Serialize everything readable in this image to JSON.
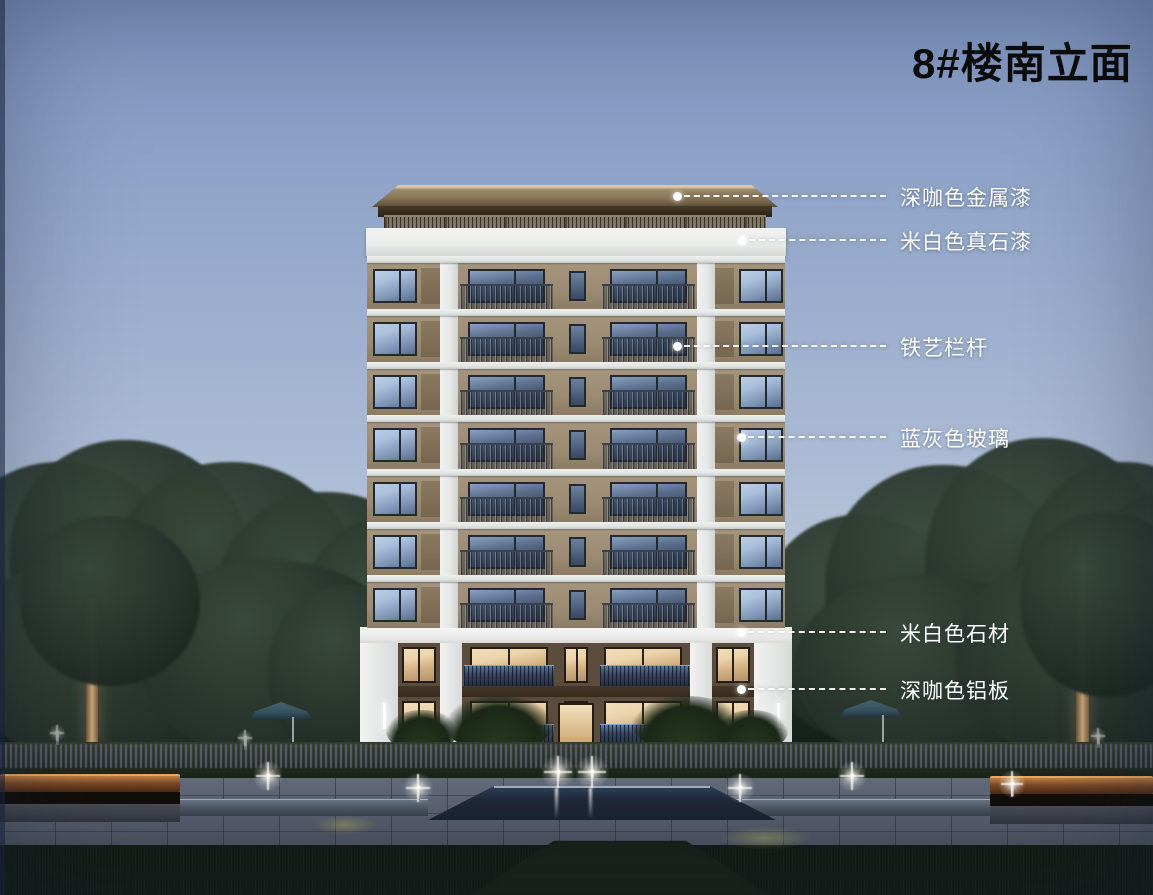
{
  "title": "8#楼南立面",
  "building": {
    "name": "8#楼",
    "elevation": "南立面",
    "typical_floor_count": 7,
    "base_floor_count": 2
  },
  "annotations": [
    {
      "label": "深咖色金属漆",
      "dot_x": 677,
      "dot_y": 196
    },
    {
      "label": "米白色真石漆",
      "dot_x": 742,
      "dot_y": 240
    },
    {
      "label": "铁艺栏杆",
      "dot_x": 677,
      "dot_y": 346
    },
    {
      "label": "蓝灰色玻璃",
      "dot_x": 741,
      "dot_y": 437
    },
    {
      "label": "米白色石材",
      "dot_x": 741,
      "dot_y": 632
    },
    {
      "label": "深咖色铝板",
      "dot_x": 741,
      "dot_y": 689
    }
  ],
  "annotation_label_x": 900,
  "annotation_line_end_x": 886,
  "colors": {
    "sky_top": "#7e95c0",
    "sky_mid": "#9fb1cf",
    "sky_low": "#c6d0e0",
    "tree": "#2c382f",
    "tree_dark": "#1e2922",
    "trunk": "#c9a87c",
    "roof": "#8d795c",
    "roof_edge": "#d9c9a5",
    "roof_under": "#2c2315",
    "railing_roof": "#7d7566",
    "parapet": "#e9ebe9",
    "wall": "#9c8b73",
    "pier": "#e5e7e6",
    "slab": "#dde1e0",
    "frame": "#232930",
    "glass_light": "#a9bfdb",
    "glass_dark": "#3f4e66",
    "stone": "#ecedec",
    "base_wall": "#5b4c3d",
    "alum": "#382c1f",
    "warm1": "#ecd3ab",
    "warm2": "#b3926c",
    "hedge_purple": "#7d7aa8",
    "plaza": "#5b6170",
    "pool": "#20293a",
    "pool_edge": "#9fb0c2",
    "grass": "#141a13",
    "bench_wood": "#7d4a27",
    "umbrella": "#35525e",
    "title_color": "#0b0b0c",
    "label_color": "#ffffff"
  }
}
